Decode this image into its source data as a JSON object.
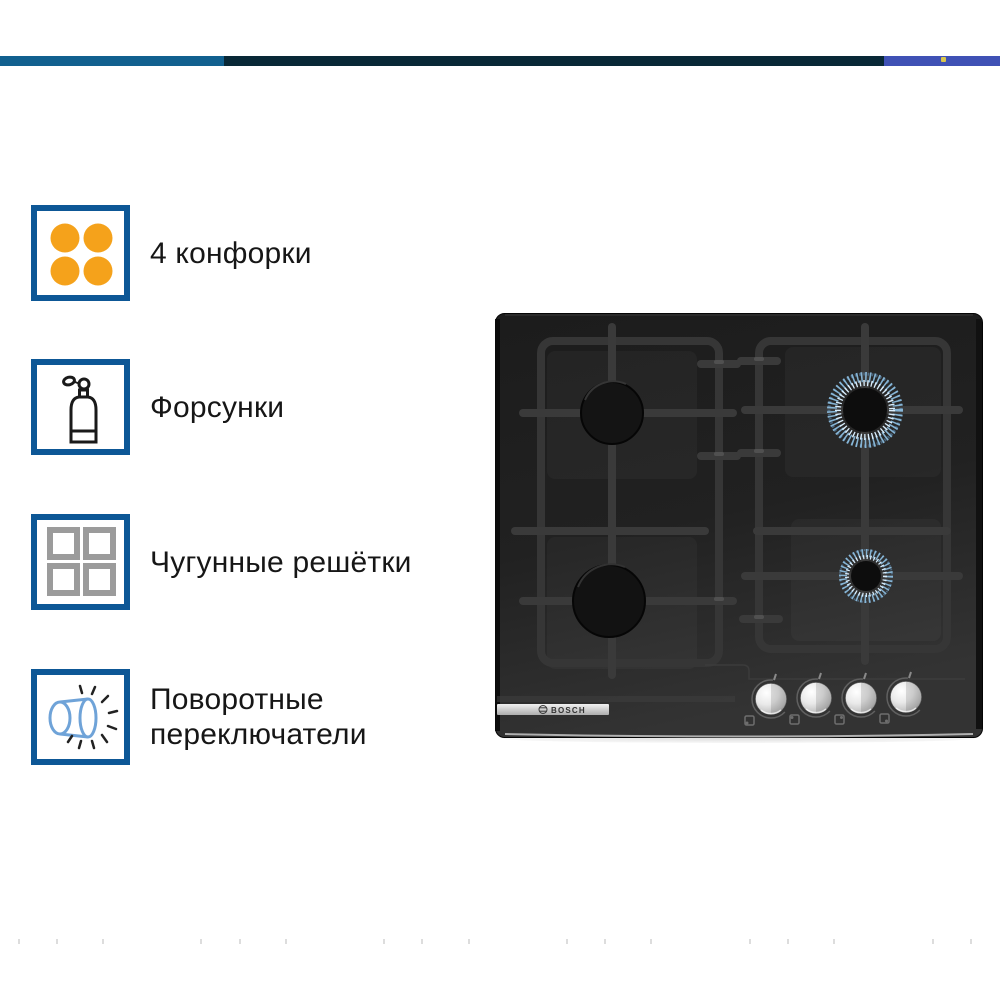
{
  "top_bar": {
    "segments": [
      {
        "name": "left",
        "color": "#11608f"
      },
      {
        "name": "middle",
        "color": "#082836"
      },
      {
        "name": "right",
        "color": "#3f51b5"
      }
    ],
    "accent_dot_color": "#d9c64d"
  },
  "features": [
    {
      "label": "4 конфорки",
      "icon": "four-burners-icon"
    },
    {
      "label": "Форсунки",
      "icon": "gas-cylinder-icon"
    },
    {
      "label": "Чугунные решётки",
      "icon": "cast-iron-grates-icon"
    },
    {
      "label": "Поворотные переключатели",
      "icon": "rotary-knob-icon"
    }
  ],
  "product": {
    "brand": "BOSCH",
    "type": "gas hob, black glass",
    "burners": [
      {
        "position": "top-left",
        "flame_on": false
      },
      {
        "position": "top-right",
        "flame_on": true
      },
      {
        "position": "bottom-left",
        "flame_on": false
      },
      {
        "position": "bottom-right",
        "flame_on": true
      }
    ],
    "knob_count": 4
  },
  "colors": {
    "bar_left": "#11608f",
    "bar_mid": "#082836",
    "bar_right": "#3f51b5",
    "dot_yellow": "#d9c64d",
    "accent_border": "#0d5796",
    "burner_orange": "#f5a21b",
    "grate_gray": "#9b9b9b",
    "knob_icon_blue": "#6fa3d8",
    "flame_blue": "#8fc2e6",
    "hob_black": "#1e1e1e"
  },
  "faint_marks_x": [
    18,
    56,
    102,
    200,
    239,
    285,
    383,
    421,
    468,
    566,
    604,
    650,
    749,
    787,
    833,
    932,
    970
  ]
}
